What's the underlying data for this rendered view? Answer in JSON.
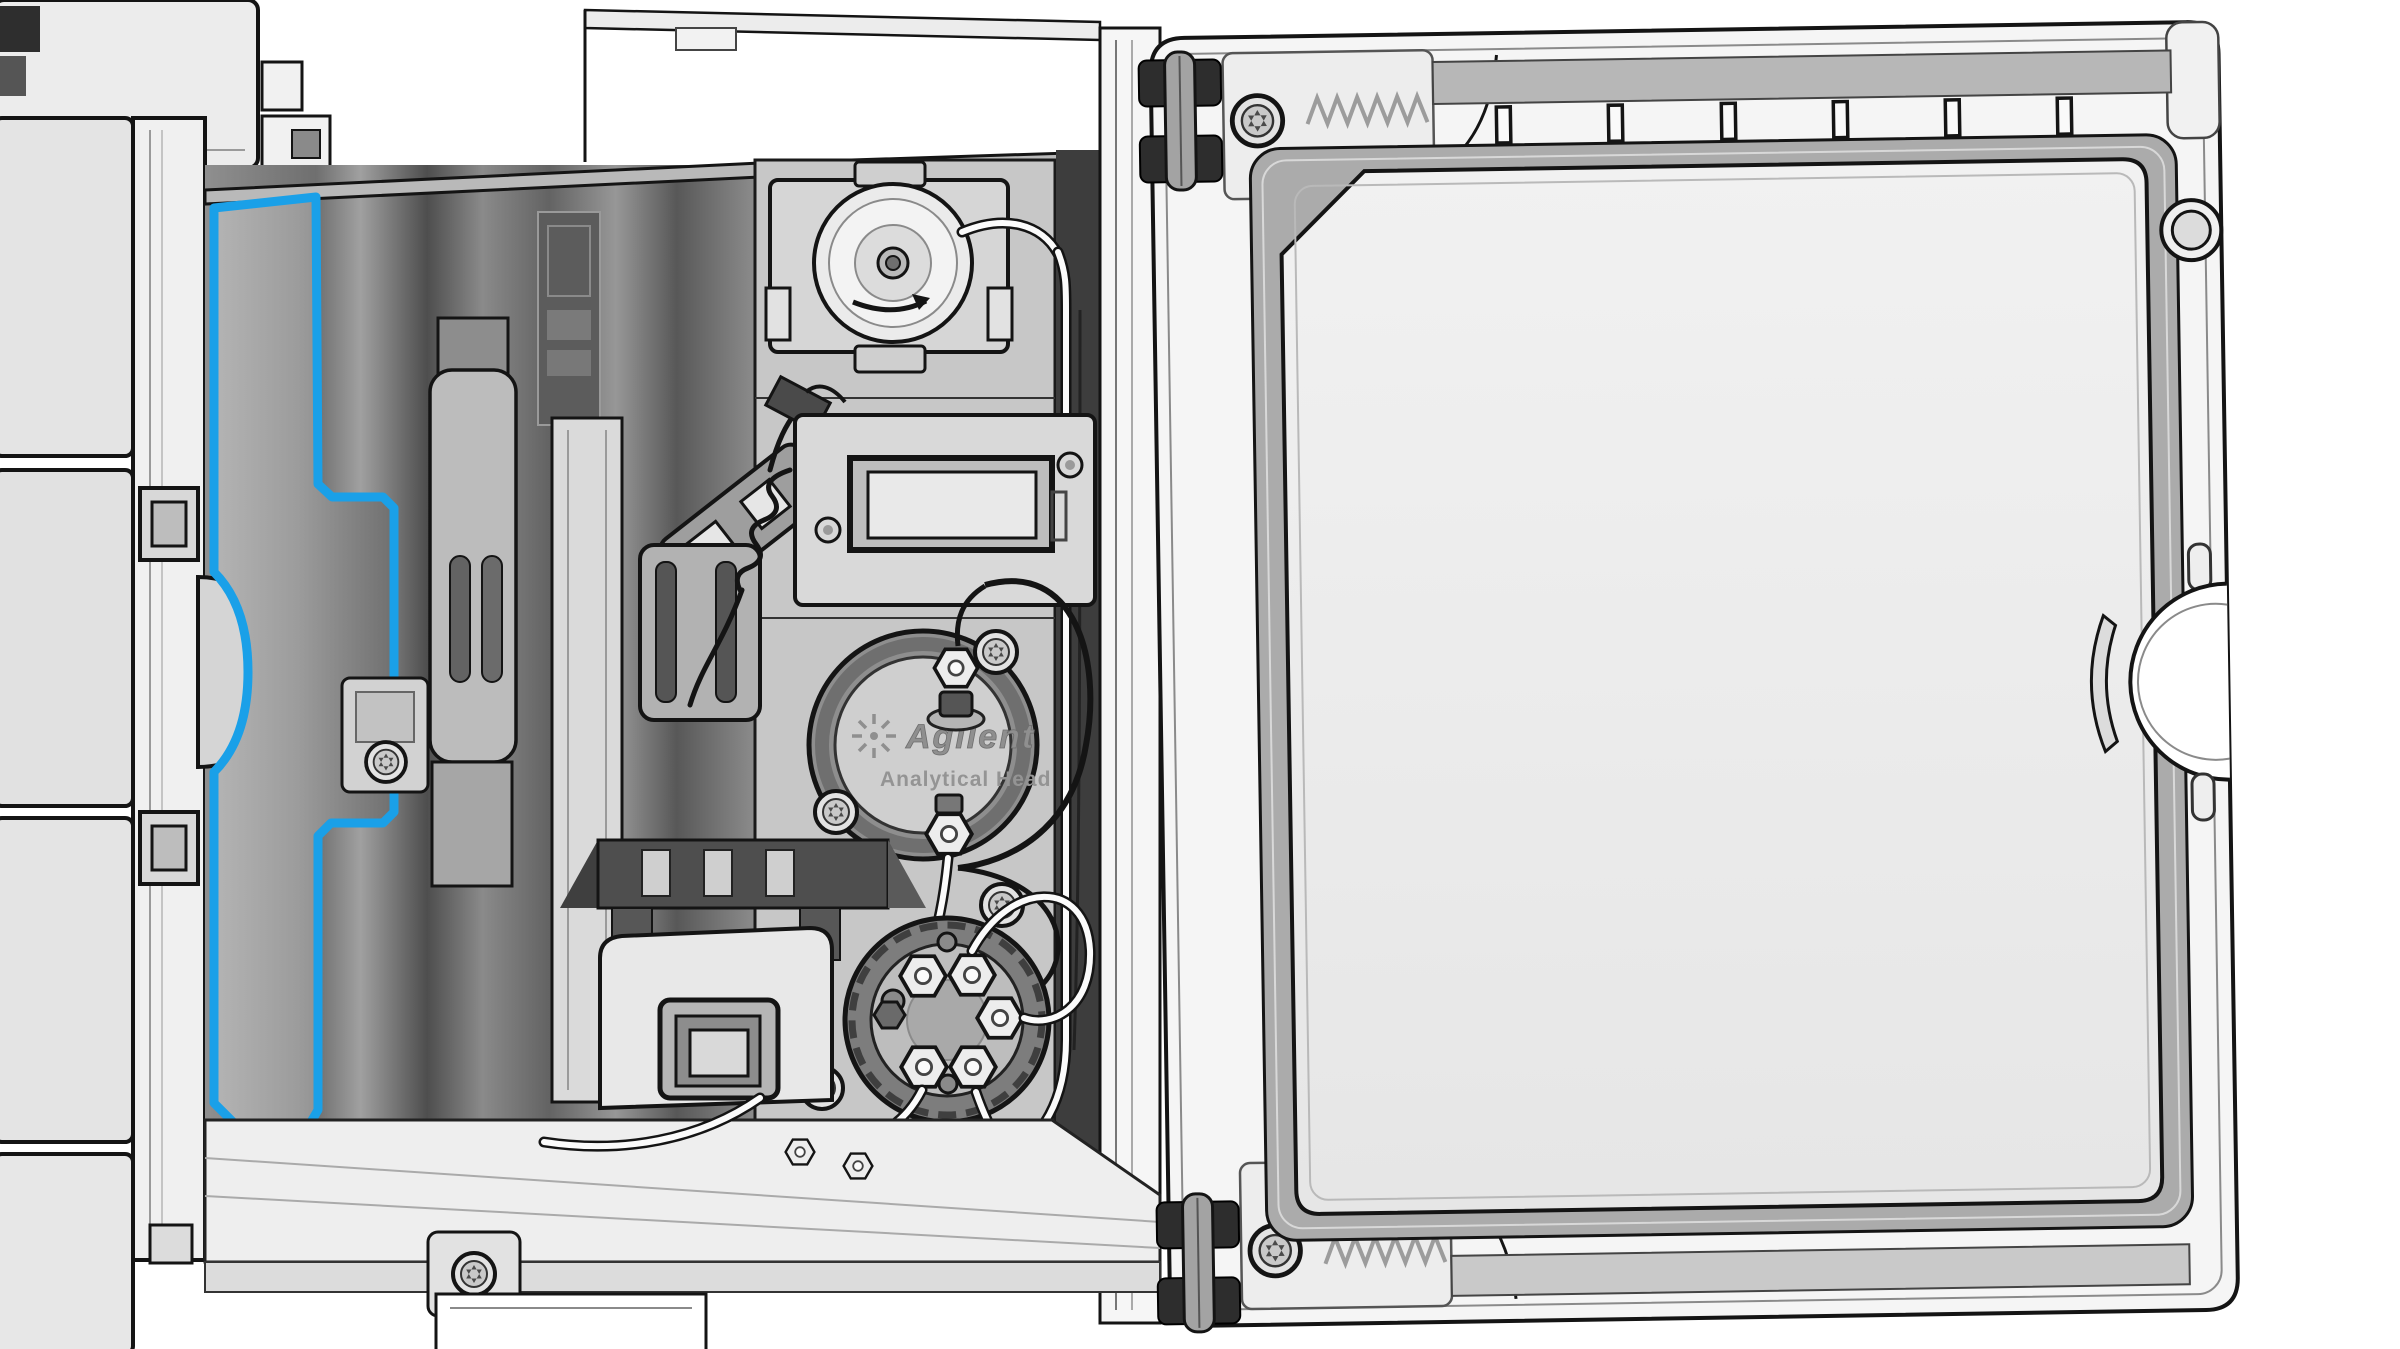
{
  "pump_head": {
    "brand": "Agilent",
    "label": "Analytical Head"
  },
  "colors": {
    "highlight": "#1AA0E8",
    "outline": "#141414",
    "bay_shadow": "#4a4a4a",
    "panel_light": "#ececec",
    "door_pane": "#ebebeb"
  },
  "door": {
    "vent_slot_count": 6,
    "hinge_count": 2
  },
  "outlet_valve": {
    "port_count": 5
  }
}
